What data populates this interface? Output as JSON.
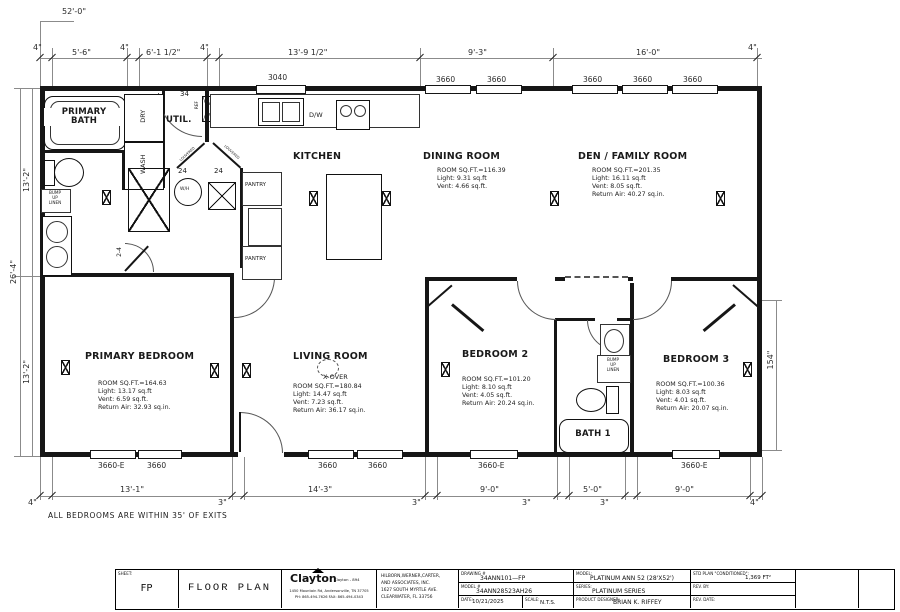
{
  "page": {
    "note": "ALL BEDROOMS ARE WITHIN 35' OF EXITS"
  },
  "dims": {
    "top": {
      "overall": "52'-0\"",
      "a": "4\"",
      "b": "5'-6\"",
      "c": "4\"",
      "d": "6'-1 1/2\"",
      "e": "4\"",
      "f": "13'-9 1/2\"",
      "g": "9'-3\"",
      "h": "16'-0\"",
      "i": "4\""
    },
    "bottom": {
      "a": "4\"",
      "b": "13'-1\"",
      "c": "3\"",
      "d": "14'-3\"",
      "e": "3\"",
      "f": "9'-0\"",
      "g": "3\"",
      "h": "5'-0\"",
      "i": "3\"",
      "j": "9'-0\"",
      "k": "4\""
    },
    "left": {
      "overall": "26'-4\"",
      "upper": "13'-2\"",
      "lower": "13'-2\""
    },
    "right": {
      "bed3": "154\""
    }
  },
  "windows": {
    "top": {
      "w1": "3040",
      "w2": "3660",
      "w3": "3660",
      "w4": "3660",
      "w5": "3660",
      "w6": "3660"
    },
    "bottom": {
      "w1": "3660-E",
      "w2": "3660",
      "w3": "3660",
      "w4": "3660",
      "w5": "3660-E",
      "w6": "3660-E"
    }
  },
  "doors": {
    "util": "34",
    "louver_a": "24",
    "louver_b": "24",
    "bath": "2-4",
    "louvered": "LOUVERED"
  },
  "rooms": {
    "primary_bath": {
      "l1": "PRIMARY",
      "l2": "BATH"
    },
    "util": {
      "name": "UTIL."
    },
    "kitchen": {
      "name": "KITCHEN"
    },
    "dining": {
      "name": "DINING ROOM",
      "s1": "ROOM SQ.FT.=116.39",
      "s2": "Light: 9.31 sq.ft",
      "s3": "Vent: 4.66 sq.ft."
    },
    "den": {
      "name": "DEN / FAMILY ROOM",
      "s1": "ROOM SQ.FT.=201.35",
      "s2": "Light: 16.11 sq.ft",
      "s3": "Vent: 8.05 sq.ft.",
      "s4": "Return Air: 40.27 sq.in."
    },
    "primary_bedroom": {
      "name": "PRIMARY BEDROOM",
      "s1": "ROOM SQ.FT.=164.63",
      "s2": "Light: 13.17 sq.ft",
      "s3": "Vent: 6.59 sq.ft.",
      "s4": "Return Air: 32.93 sq.in."
    },
    "living": {
      "name": "LIVING ROOM",
      "s1": "ROOM SQ.FT.=180.84",
      "s2": "Light: 14.47 sq.ft",
      "s3": "Vent: 7.23 sq.ft.",
      "s4": "Return Air: 36.17 sq.in."
    },
    "bedroom2": {
      "name": "BEDROOM 2",
      "s1": "ROOM SQ.FT.=101.20",
      "s2": "Light: 8.10 sq.ft",
      "s3": "Vent: 4.05 sq.ft.",
      "s4": "Return Air: 20.24 sq.in."
    },
    "bedroom3": {
      "name": "BEDROOM 3",
      "s1": "ROOM SQ.FT.=100.36",
      "s2": "Light: 8.03 sq.ft",
      "s3": "Vent: 4.01 sq.ft.",
      "s4": "Return Air: 20.07 sq.in."
    },
    "bath1": {
      "name": "BATH 1"
    }
  },
  "fixtures": {
    "dry": "DRY",
    "wash": "WASH",
    "dw": "D/W",
    "wh": "W/H",
    "ref": "REF",
    "pantry_a": "PANTRY",
    "pantry_b": "PANTRY",
    "xover": "X-OVER",
    "linen_l1": "BUMP",
    "linen_l2": "UP",
    "linen_l3": "LINEN"
  },
  "title_block": {
    "sheet_label": "SHEET:",
    "sheet": "FP",
    "title": "FLOOR PLAN",
    "clayton_name": "Clayton",
    "clayton_sub": "Clayton - 894",
    "clayton_addr1": "1450 Mountain Rd, Andersonville, TN 37705",
    "clayton_addr2": "PH: 865-494-7626 FAX: 865-494-0343",
    "firm1": "HILBORN,WERNER,CARTER,",
    "firm2": "AND ASSOCIATES, INC.",
    "firm3": "1627 SOUTH MYRTLE AVE.",
    "firm4": "CLEARWATER, FL  33756",
    "drawing_label": "DRAWING #",
    "drawing_no": "34ANN101—FP",
    "model_no_label": "MODEL #",
    "model_no": "34ANN28523AH26",
    "date_label": "DATE:",
    "date": "10/21/2025",
    "scale_label": "SCALE:",
    "scale": "N.T.S.",
    "model_label": "MODEL:",
    "model": "PLATINUM ANN 52 (28'X52')",
    "series_label": "SERIES:",
    "series": "PLATINUM SERIES",
    "designer_label": "PRODUCT DESIGNER:",
    "designer": "BRIAN K. RIFFEY",
    "std_label": "STD PLAN \"CONDITIONED\":",
    "std_value": "1,369 FT²",
    "rev_by_label": "REV. BY:",
    "rev_date_label": "REV. DATE:"
  }
}
